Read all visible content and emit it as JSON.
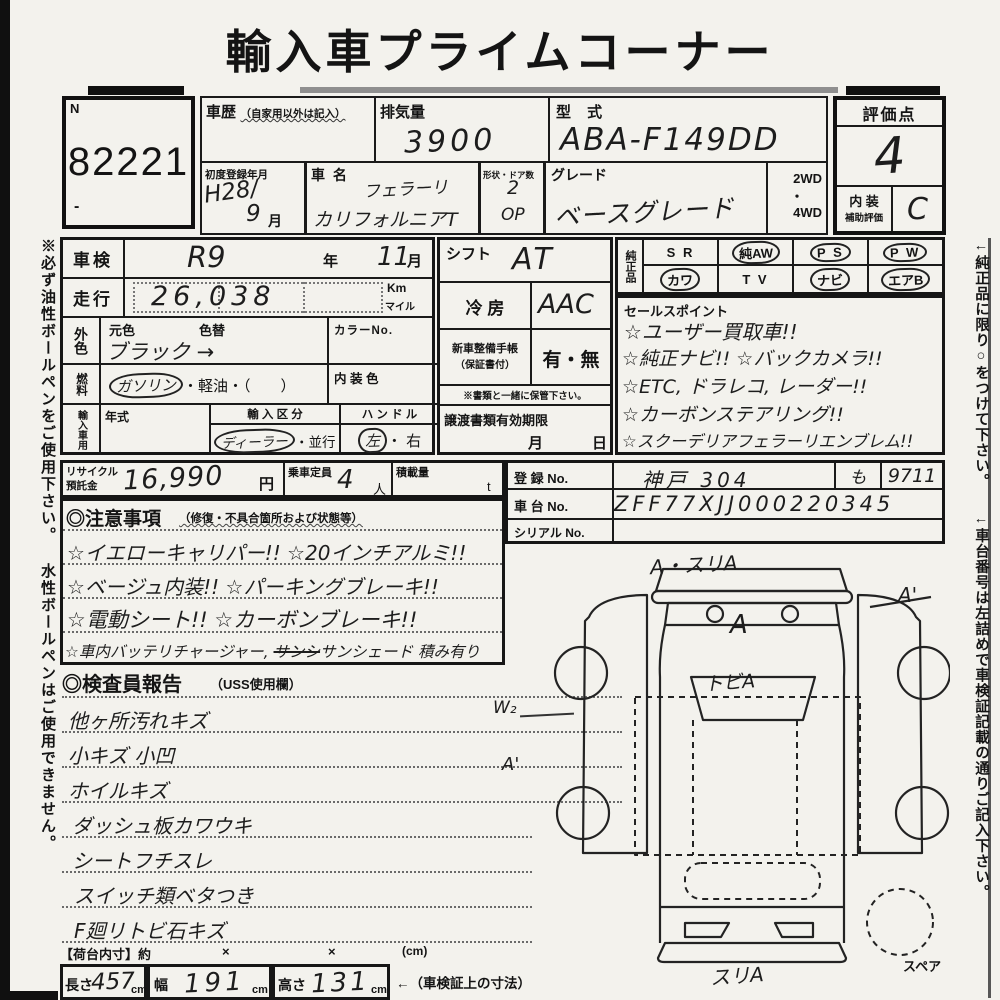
{
  "title": "輸入車プライムコーナー",
  "lot": {
    "n": "N",
    "number": "82221",
    "dash": "-"
  },
  "header": {
    "history_label": "車歴",
    "history_note": "（自家用以外は記入）",
    "disp_label": "排気量",
    "disp_value": "3900",
    "model_label": "型 式",
    "model_value": "ABA-F149DD",
    "firstreg_label": "初度登録年月",
    "firstreg_value": "H28/",
    "firstreg_month": "9",
    "firstreg_month_suffix": "月",
    "carname_label": "車  名",
    "carname_1": "フェラーリ",
    "carname_2": "カリフォルニアT",
    "shape_label": "形状・ドア数",
    "shape_value": "2",
    "shape_value2": "OP",
    "grade_label": "グレード",
    "grade_value": "ベースグレード",
    "drive_1": "2WD",
    "drive_dot": "・",
    "drive_2": "4WD",
    "score_label": "評価点",
    "score_value": "4",
    "int_label1": "内 装",
    "int_label2": "補助評価",
    "int_value": "C"
  },
  "left_panel": {
    "shaken_label": "車検",
    "shaken_value": "R9",
    "shaken_y": "年",
    "shaken_month": "11",
    "shaken_m": "月",
    "run_label": "走行",
    "run_value": "26,038",
    "run_km": "Km",
    "run_mile": "マイル",
    "color_label": "外色",
    "moto_label": "元色",
    "kae_label": "色替",
    "color_value": "ブラック →",
    "colorno_label": "カラーNo.",
    "fuel_label": "燃料",
    "fuel_opt1": "ガソリン",
    "fuel_opt1_circled": true,
    "fuel_rest": "・軽油・（　　）",
    "int_color_label": "内 装 色",
    "import_label": "輸入車用",
    "year_label": "年式",
    "class_label": "輸 入 区 分",
    "class_opt1": "ディーラー",
    "class_opt1_circled": true,
    "class_rest": "・並行",
    "handle_label": "ハ ン ド ル",
    "handle_opt1": "左",
    "handle_opt1_circled": true,
    "handle_rest": "・ 右"
  },
  "middle_panel": {
    "shift_label": "シフト",
    "shift_value": "AT",
    "ac_label": "冷 房",
    "ac_value": "AAC",
    "book_label1": "新車整備手帳",
    "book_label2": "（保証書付）",
    "book_value": "有・無",
    "keep_note": "※書類と一緒に保管下さい。",
    "transfer_label": "譲渡書類有効期限",
    "transfer_month": "月",
    "transfer_day": "日"
  },
  "genuine": {
    "label": "純正品",
    "r1": [
      {
        "t": "S R",
        "c": false
      },
      {
        "t": "純AW",
        "c": true
      },
      {
        "t": "P S",
        "c": true
      },
      {
        "t": "P W",
        "c": true
      }
    ],
    "r2": [
      {
        "t": "カワ",
        "c": true
      },
      {
        "t": "T V",
        "c": false
      },
      {
        "t": "ナビ",
        "c": true
      },
      {
        "t": "エアB",
        "c": true
      }
    ]
  },
  "sales": {
    "label": "セールスポイント",
    "lines": [
      "☆ユーザー買取車!!",
      "☆純正ナビ!! ☆バックカメラ!!",
      "☆ETC, ドラレコ, レーダー!!",
      "☆カーボンステアリング!!",
      "☆スクーデリアフェラーリエンブレム!!"
    ]
  },
  "registration": {
    "reg_label": "登 録 No.",
    "reg_v1": "神戸 304",
    "reg_v2": "も",
    "reg_v3": "9711",
    "chassis_label": "車 台 No.",
    "chassis_value": "ZFF77XJJ000220345",
    "serial_label": "シリアル No."
  },
  "recycle": {
    "label1": "リサイクル",
    "label2": "預託金",
    "value": "16,990",
    "yen": "円",
    "cap_label": "乗車定員",
    "cap_value": "4",
    "cap_unit": "人",
    "load_label": "積載量",
    "load_unit": "t"
  },
  "notes": {
    "title": "◎注意事項",
    "subtitle": "（修復・不具合箇所および状態等）",
    "line1": "☆イエローキャリパー!! ☆20インチアルミ!!",
    "line2": "☆ベージュ内装!! ☆パーキングブレーキ!!",
    "line3": "☆電動シート!! ☆カーボンブレーキ!!",
    "line4a": "☆車内バッテリチャージャー, ",
    "line4_struck": "サンシ",
    "line4b": "サンシェード 積み有り"
  },
  "inspector": {
    "title": "◎検査員報告",
    "subtitle": "（USS使用欄）",
    "lines": [
      "他ヶ所汚れキズ",
      "小キズ 小凹",
      "ホイルキズ",
      "ダッシュ板カワウキ",
      "シートフチスレ",
      "スイッチ類ベタつき",
      "F廻リトビ石キズ"
    ]
  },
  "diagram": {
    "label_top": "A・スリA",
    "label_hood": "A",
    "label_windshield": "トビA",
    "label_right": "A'",
    "label_w2": "W₂",
    "label_a1_left": "A'",
    "label_bottom": "スリA",
    "spare": "スペア"
  },
  "dims": {
    "title": "【荷台内寸】約",
    "x1": "×",
    "x2": "×",
    "cm": "(cm)",
    "len_label": "長さ",
    "len_value": "457",
    "len_unit": "cm",
    "wid_label": "幅",
    "wid_value": "191",
    "wid_unit": "cm",
    "hei_label": "高さ",
    "hei_value": "131",
    "hei_unit": "cm",
    "note": "←（車検証上の寸法）"
  },
  "sidebars": {
    "left": "※必ず油性ボールペンをご使用下さい。 水性ボールペンはご使用できません。",
    "right1": "←純正品に限り○をつけて下さい。",
    "right2": "←車台番号は左詰めで車検証記載の通りご記入下さい。"
  }
}
